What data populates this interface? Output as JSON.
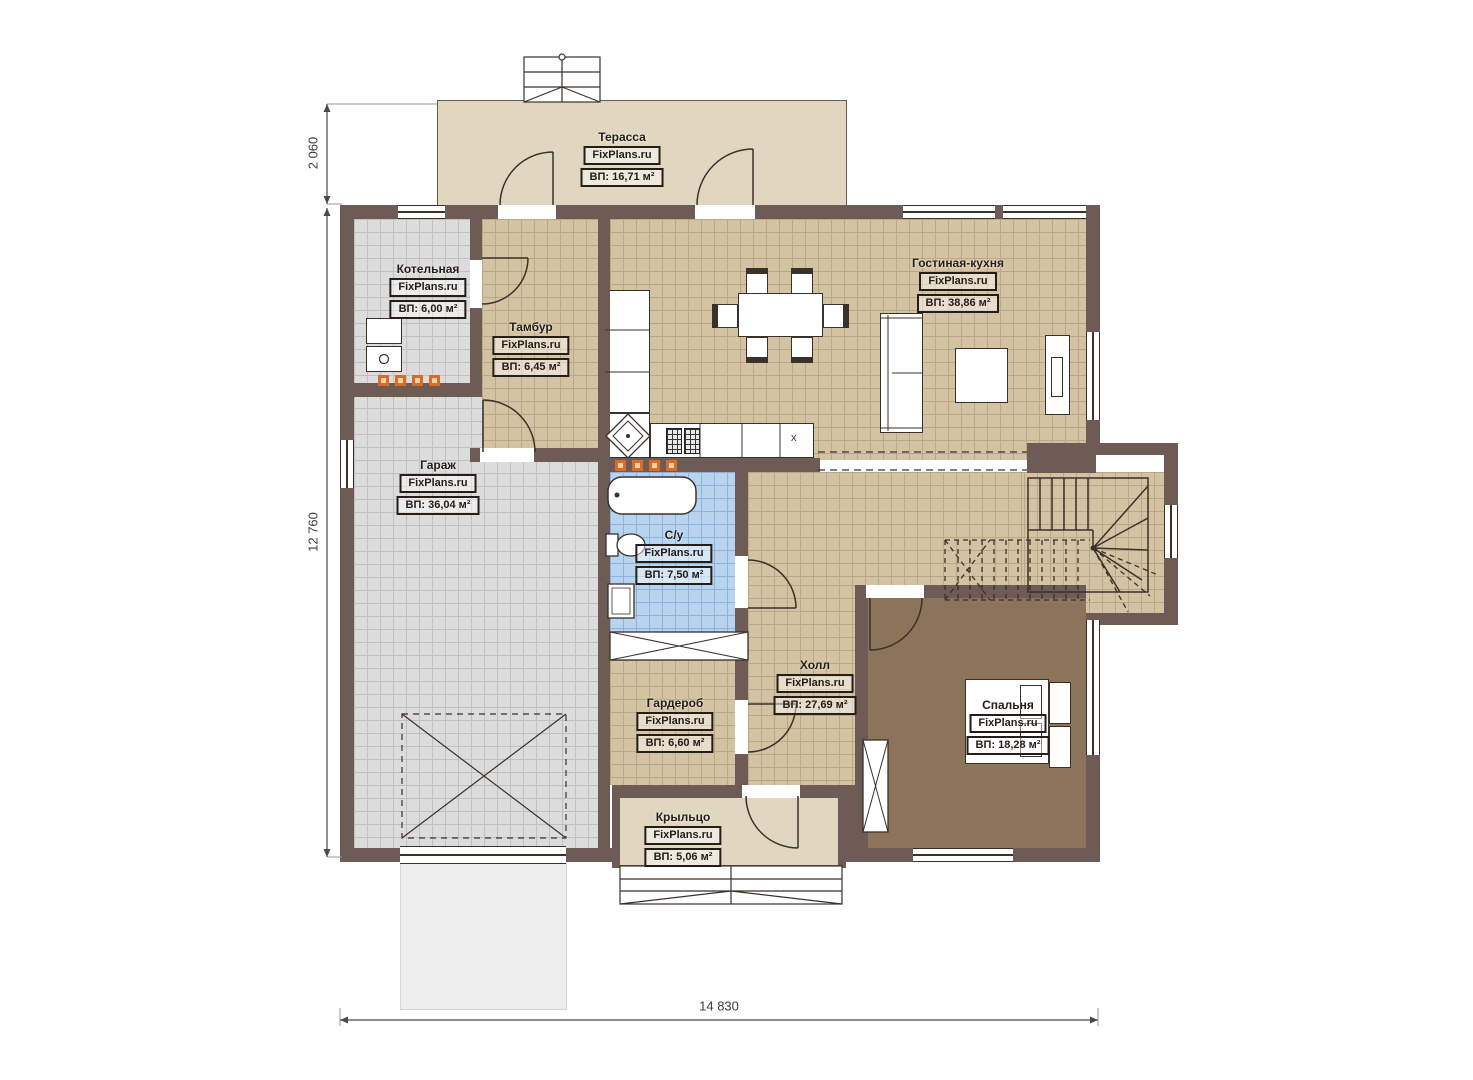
{
  "plan": {
    "brand": "FixPlans.ru",
    "rooms": [
      {
        "key": "terrace",
        "name": "Терасса",
        "area": "ВП: 16,71 м²"
      },
      {
        "key": "boiler",
        "name": "Котельная",
        "area": "ВП: 6,00 м²"
      },
      {
        "key": "tambour",
        "name": "Тамбур",
        "area": "ВП: 6,45 м²"
      },
      {
        "key": "living_kitchen",
        "name": "Гостиная-кухня",
        "area": "ВП: 38,86 м²"
      },
      {
        "key": "garage",
        "name": "Гараж",
        "area": "ВП: 36,04 м²"
      },
      {
        "key": "bathroom",
        "name": "С/у",
        "area": "ВП: 7,50 м²"
      },
      {
        "key": "hall",
        "name": "Холл",
        "area": "ВП: 27,69 м²"
      },
      {
        "key": "wardrobe",
        "name": "Гардероб",
        "area": "ВП: 6,60 м²"
      },
      {
        "key": "bedroom",
        "name": "Спальня",
        "area": "ВП: 18,28 м²"
      },
      {
        "key": "porch",
        "name": "Крыльцо",
        "area": "ВП: 5,06 м²"
      }
    ],
    "dimensions": {
      "top_left_vertical": "2 060",
      "left_vertical": "12 760",
      "bottom_horizontal": "14 830"
    },
    "counter_mark": "x",
    "colors": {
      "wall": "#6e5b56",
      "floor_beige": "#d3c3a2",
      "floor_grey": "#dcdcdc",
      "floor_blue": "#b7d3ee",
      "floor_bedroom": "#8b7459",
      "outdoor": "#e1d7c1",
      "heater": "#d96c28"
    }
  }
}
